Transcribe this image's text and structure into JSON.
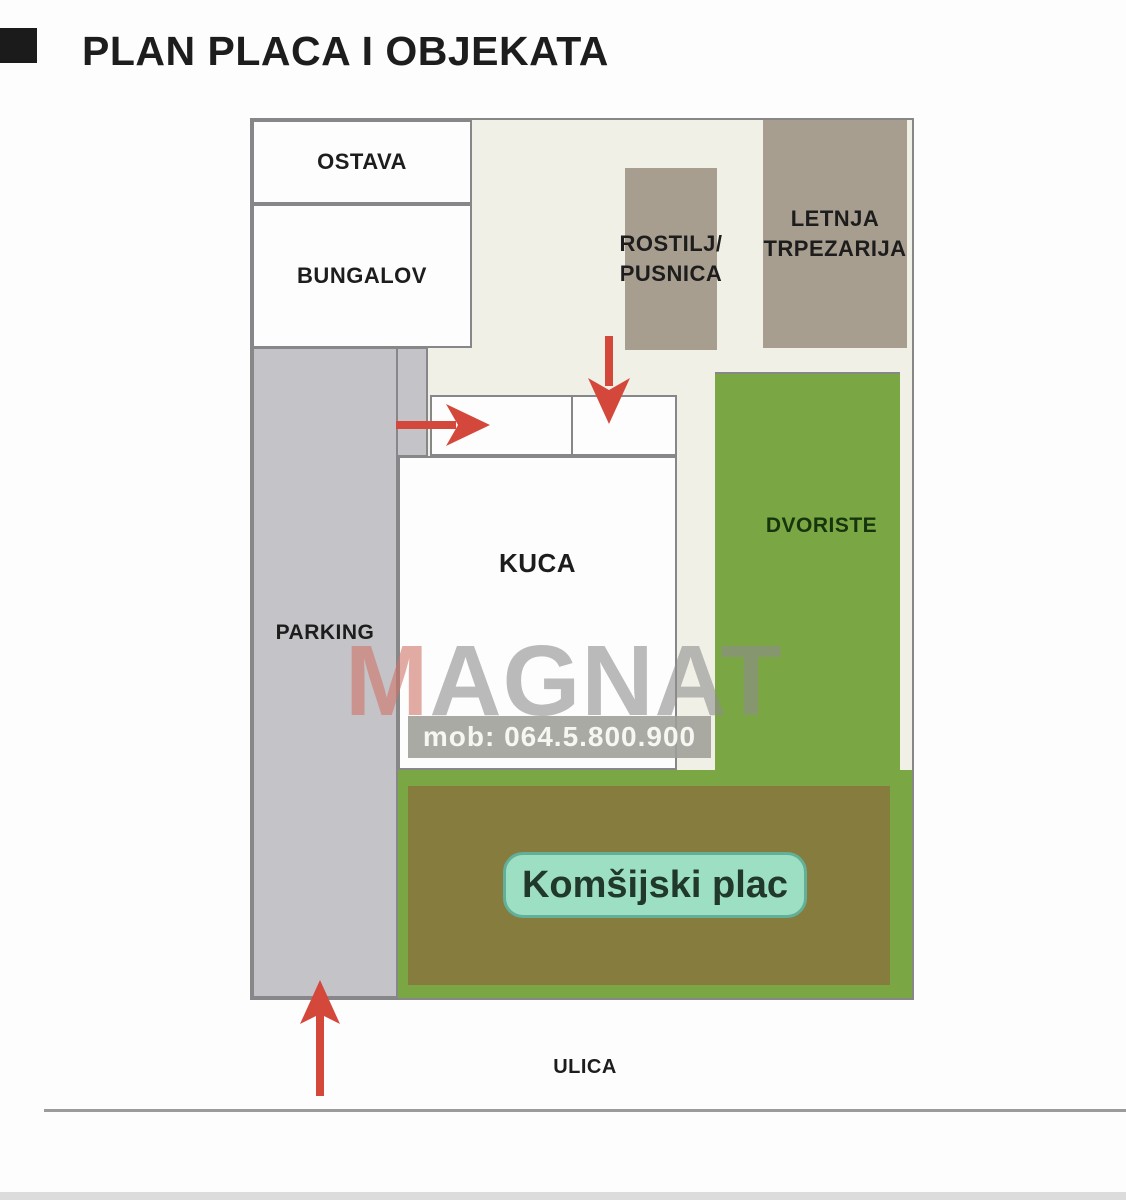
{
  "page": {
    "title": "PLAN PLACA I OBJEKATA"
  },
  "labels": {
    "ostava": "OSTAVA",
    "bungalov": "BUNGALOV",
    "rostilj_line1": "ROSTILJ/",
    "rostilj_line2": "PUSNICA",
    "letnja_line1": "LETNJA",
    "letnja_line2": "TRPEZARIJA",
    "parking": "PARKING",
    "kuca": "KUCA",
    "dvoriste": "DVORISTE",
    "komsijski_plac": "Komšijski plac",
    "ulica": "ULICA"
  },
  "watermark": {
    "letter_m": "M",
    "letters_rest": "AGNAT",
    "phone": "mob: 064.5.800.900"
  },
  "colors": {
    "plot_bg": "#f1f0e6",
    "building_taupe": "#a79e8f",
    "parking_gray": "#c4c3c8",
    "yard_green": "#7aa743",
    "neighbor_olive": "#867c3e",
    "badge_mint": "#9ddfc2",
    "badge_mint_border": "#62b099",
    "arrow_red": "#d4483c",
    "border_gray": "#87878a",
    "watermark_gray": "#8e8e8e",
    "watermark_m_red": "#cf7468",
    "text_black": "#1d1d1d"
  }
}
